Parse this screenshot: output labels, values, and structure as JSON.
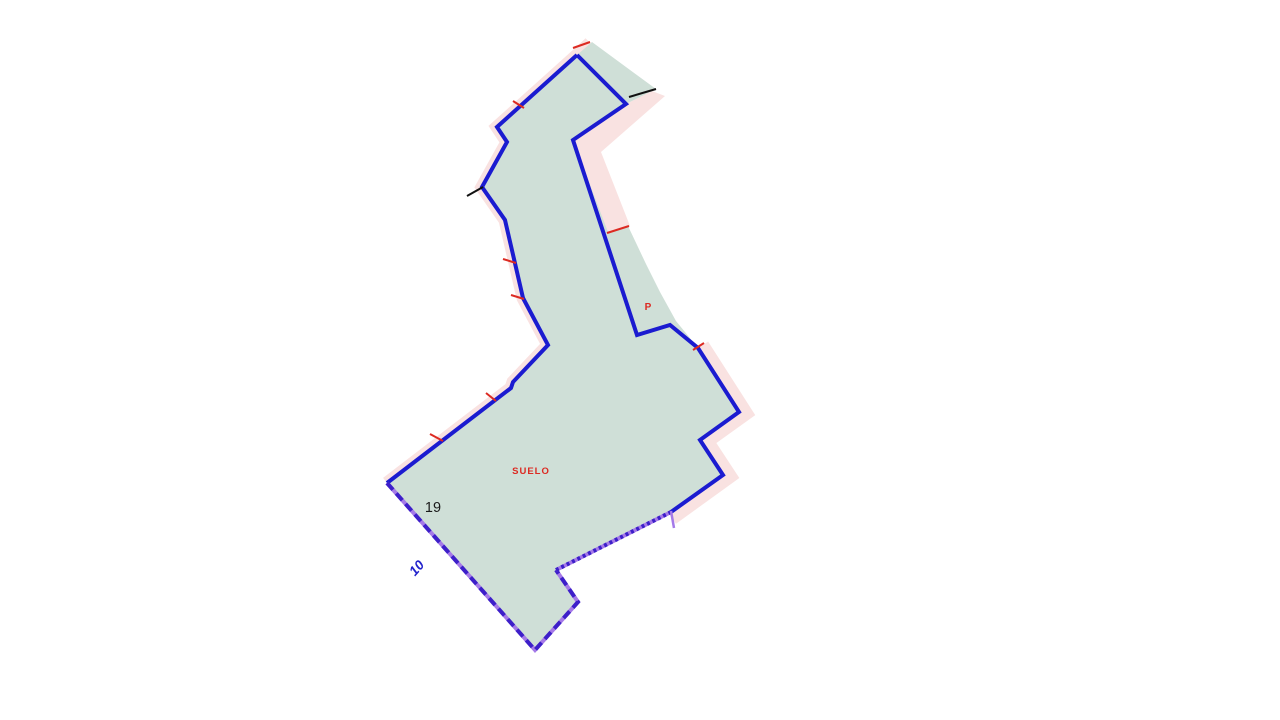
{
  "map": {
    "background": "#ffffff",
    "labels": {
      "land_use": "SUELO",
      "sub_parcel": "P",
      "parcel_number": "19",
      "adjacent_number": "10"
    },
    "colors": {
      "parcel_fill": "#cfdfd7",
      "adjacent_band_pink": "#f9e2e1",
      "boundary_blue": "#1b1bd0",
      "dashed_boundary_dark_purple": "#3d1fc9",
      "dashed_boundary_light_purple": "#a57ae8",
      "mark_red": "#dc2a22",
      "mark_black": "#111111",
      "label_red": "#dc2a22",
      "label_black": "#1a1a1a",
      "label_blue": "#2323cc"
    },
    "geometry": {
      "parcel_fill_points": "592,42 656,89 626,104 573,140 608,232 628,226 646,264 660,292 676,321 698,348 739,412 700,440 723,475 671,512 556,570 578,602 535,650 387,483 511,388 513,382 548,345 523,298 505,220 482,187 507,142 497,127 577,55",
      "pink_band_left_points": "590,43 577,55 497,127 507,142 482,187 505,220 523,298 548,345 513,382 511,388 387,483",
      "pink_band_right_points": "698,348 739,412 700,440 723,475 669,514",
      "pink_chevron_points": "626,104 652,91 665,96 601,152 630,226 608,233 573,140",
      "boundary_left_points": "577,55 497,127 507,142 482,187 505,220 523,298 548,345 513,382 511,388 387,483",
      "boundary_right_points": "577,55 626,104 573,140 637,335 670,325 698,348 739,412 700,440 723,475 671,512",
      "dashed_edge_points": "387,483 535,650 578,602 556,570",
      "dotted_edge_points": "556,570 671,512",
      "purple_tick_points": "671,511 674,528",
      "red_marks": [
        "573,48 590,42",
        "513,101 524,108",
        "503,259 516,263",
        "511,295 524,299",
        "486,393 496,401",
        "430,434 443,441",
        "693,350 704,343",
        "607,233 629,226"
      ],
      "black_marks": [
        "629,97 656,89",
        "467,196 483,187"
      ]
    }
  }
}
